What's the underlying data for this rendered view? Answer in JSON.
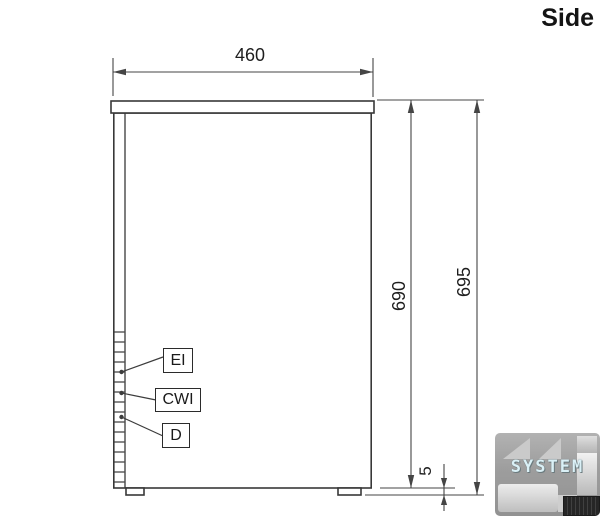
{
  "drawing": {
    "view_title": "Side",
    "dimensions": {
      "width": "460",
      "body_height": "690",
      "total_height": "695",
      "foot_gap": "5"
    },
    "connections": [
      {
        "label": "EI"
      },
      {
        "label": "CWI"
      },
      {
        "label": "D"
      }
    ]
  },
  "watermark": {
    "brand": "SYSTEM"
  },
  "colors": {
    "outline": "#383838",
    "dimension": "#454545",
    "text": "#1e1e1e",
    "watermark_bg": "#9a9a9a",
    "watermark_text": "#d9f0f6"
  }
}
